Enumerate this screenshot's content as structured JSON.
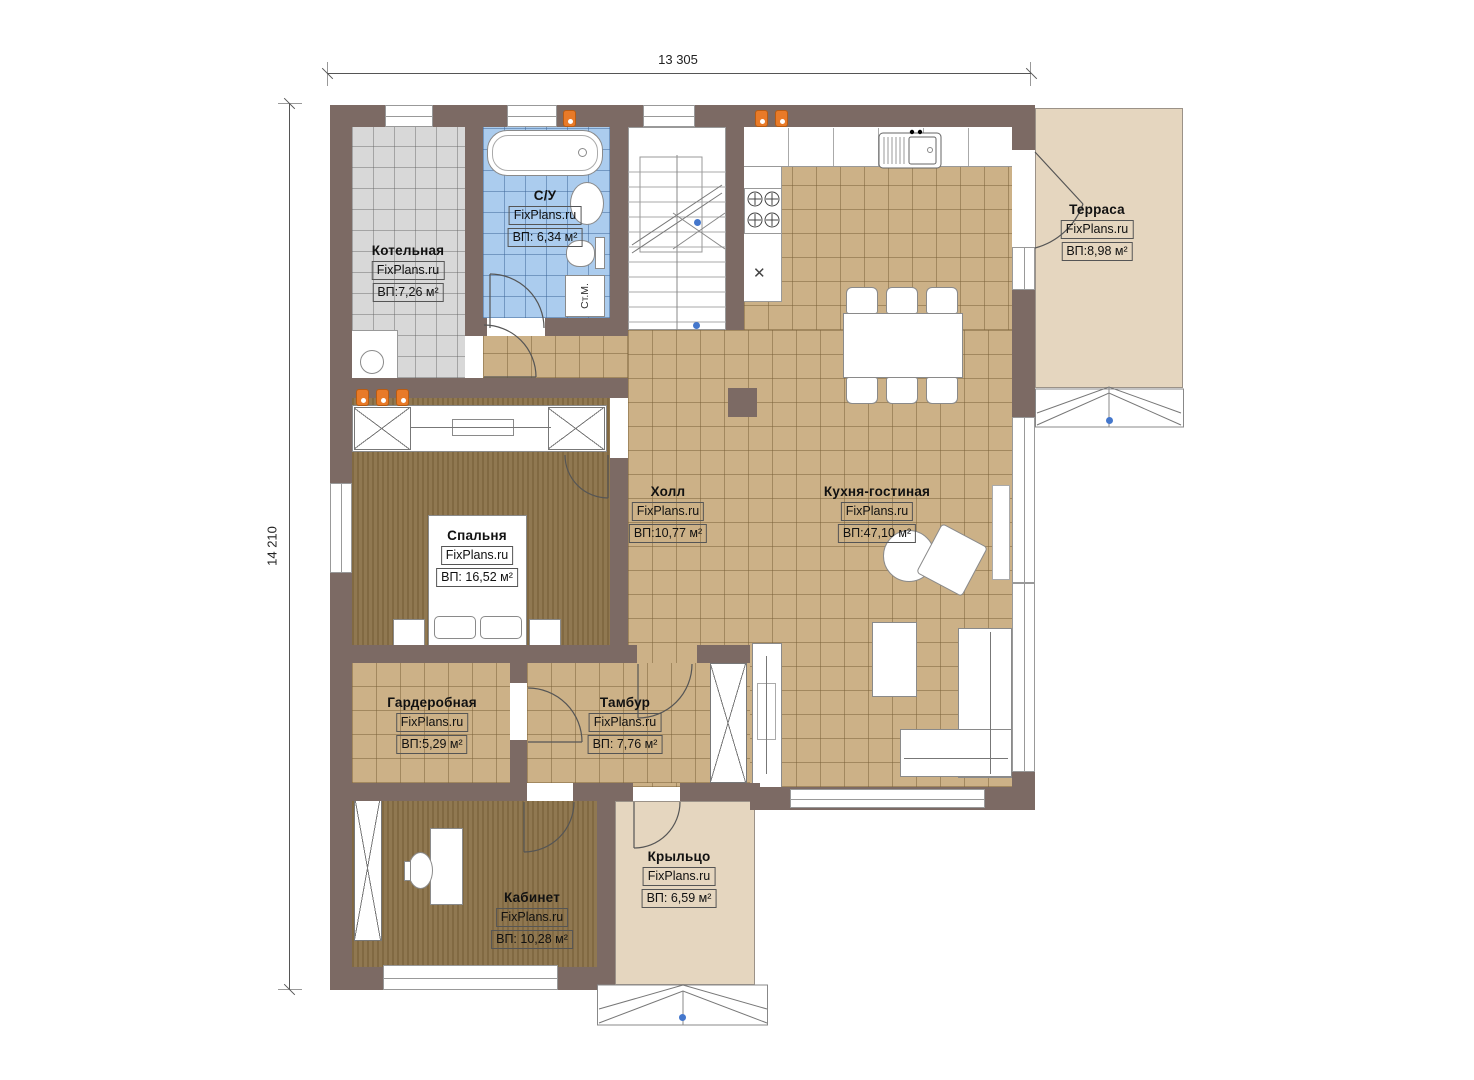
{
  "dimensions": {
    "top": "13 305",
    "left": "14 210"
  },
  "rooms": [
    {
      "name": "Котельная",
      "brand": "FixPlans.ru",
      "area": "ВП:7,26 м²"
    },
    {
      "name": "С/У",
      "brand": "FixPlans.ru",
      "area": "ВП: 6,34 м²"
    },
    {
      "name": "Терраса",
      "brand": "FixPlans.ru",
      "area": "ВП:8,98 м²"
    },
    {
      "name": "Холл",
      "brand": "FixPlans.ru",
      "area": "ВП:10,77 м²"
    },
    {
      "name": "Кухня-гостиная",
      "brand": "FixPlans.ru",
      "area": "ВП:47,10 м²"
    },
    {
      "name": "Спальня",
      "brand": "FixPlans.ru",
      "area": "ВП: 16,52 м²"
    },
    {
      "name": "Гардеробная",
      "brand": "FixPlans.ru",
      "area": "ВП:5,29 м²"
    },
    {
      "name": "Тамбур",
      "brand": "FixPlans.ru",
      "area": "ВП: 7,76 м²"
    },
    {
      "name": "Кабинет",
      "brand": "FixPlans.ru",
      "area": "ВП: 10,28 м²"
    },
    {
      "name": "Крыльцо",
      "brand": "FixPlans.ru",
      "area": "ВП: 6,59 м²"
    }
  ],
  "labels": {
    "washer": "Ст.М."
  },
  "colors": {
    "wall": "#7c6a64",
    "tile_tan": "#ccb187",
    "tile_gray": "#d8d8d8",
    "tile_blue": "#abccee",
    "wood": "#8a7148",
    "deck": "#e5d6bf",
    "vent_orange": "#e87a28",
    "marker_blue": "#4477cc"
  }
}
